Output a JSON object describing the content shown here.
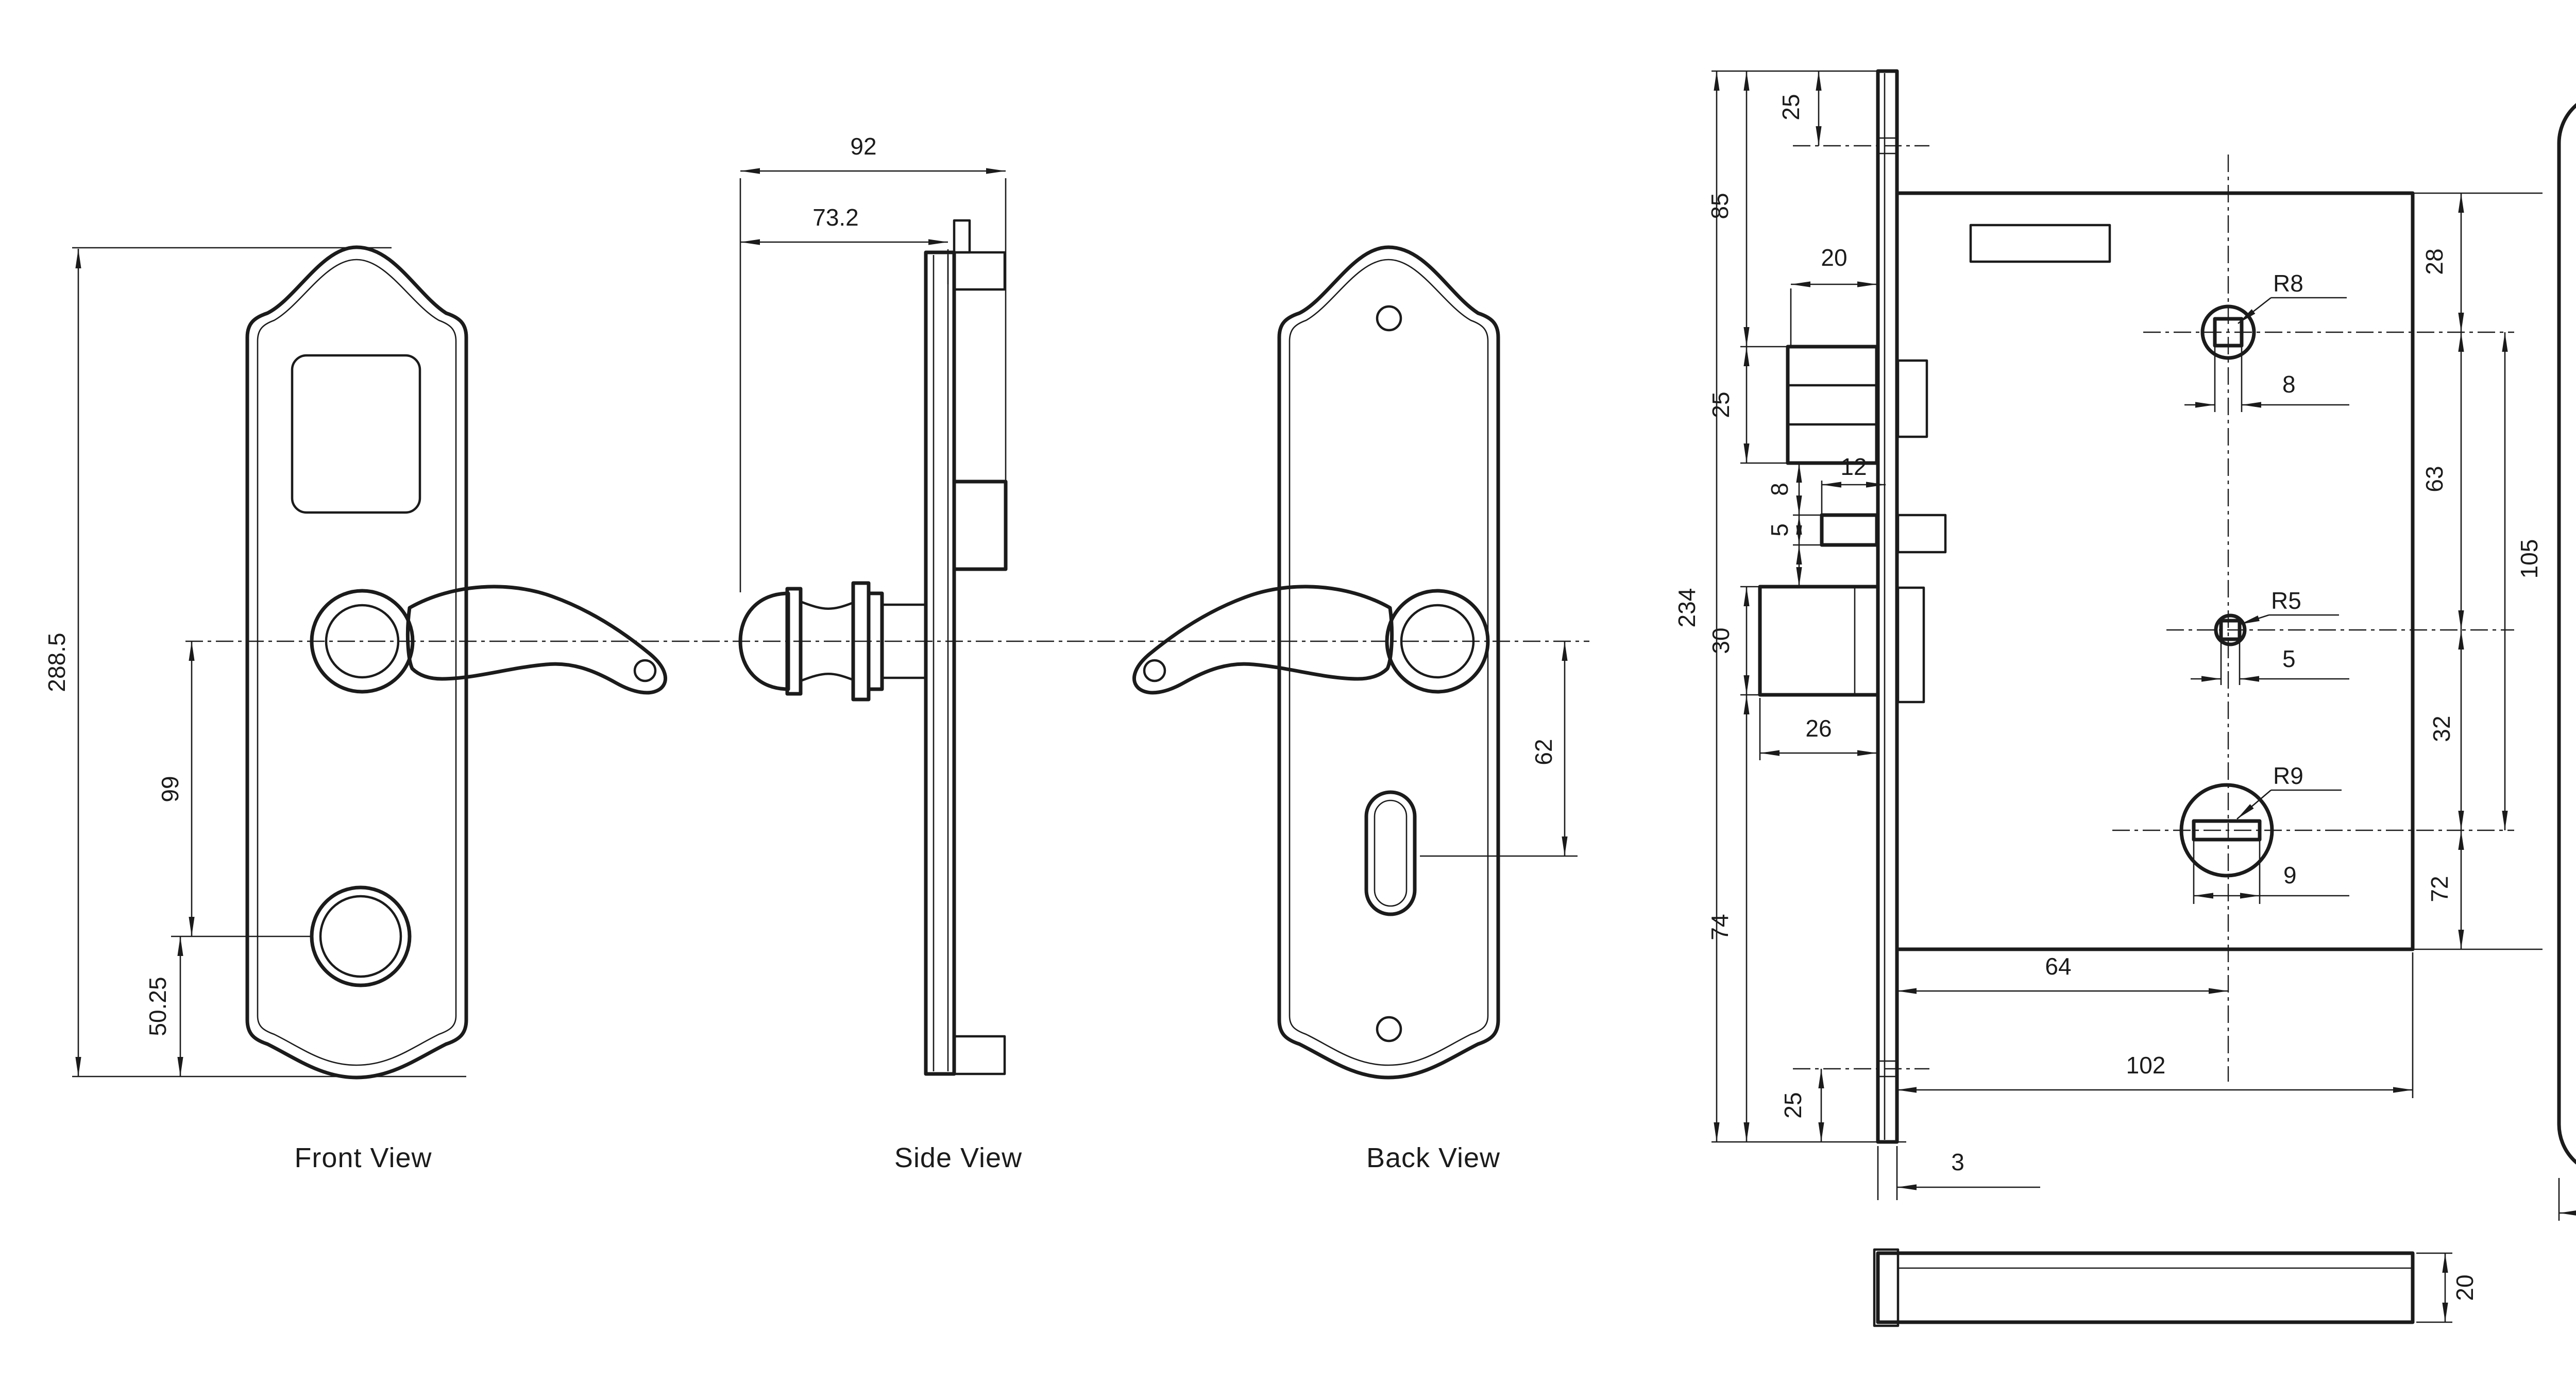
{
  "views": {
    "front": {
      "label": "Front View",
      "overall_height": "288.5",
      "handle_to_cylinder": "99",
      "cylinder_to_bottom": "50.25"
    },
    "side": {
      "label": "Side View",
      "total_depth": "92",
      "handle_depth": "73.2"
    },
    "back": {
      "label": "Back View",
      "handle_to_keyhole": "62"
    }
  },
  "lock": {
    "total_height": "234",
    "top_to_screw": "25",
    "top_to_latch": "85",
    "latch_protrusion": "20",
    "latch_height": "25",
    "latch_to_pin": "8",
    "pin_width": "12",
    "pin_height": "5",
    "deadbolt_height": "30",
    "deadbolt_width": "26",
    "deadbolt_to_bottom": "74",
    "bottom_to_screw": "25",
    "faceplate_thickness": "3",
    "case_top_to_follower": "28",
    "follower_to_spindle": "63",
    "spindle_to_cylinder": "32",
    "cylinder_to_case_bottom": "72",
    "follower_to_cylinder": "105",
    "follower_radius": "R8",
    "follower_square": "8",
    "spindle_radius": "R5",
    "spindle_square": "5",
    "cylinder_radius": "R9",
    "cylinder_slot": "9",
    "backset": "64",
    "case_length": "102",
    "case_thickness": "20"
  },
  "strike": {
    "corner_radius": "R11",
    "latch_cutout_width": "15",
    "bolt_cutout_width": "15",
    "lower_cutout_width": "10",
    "plate_width": "22"
  }
}
